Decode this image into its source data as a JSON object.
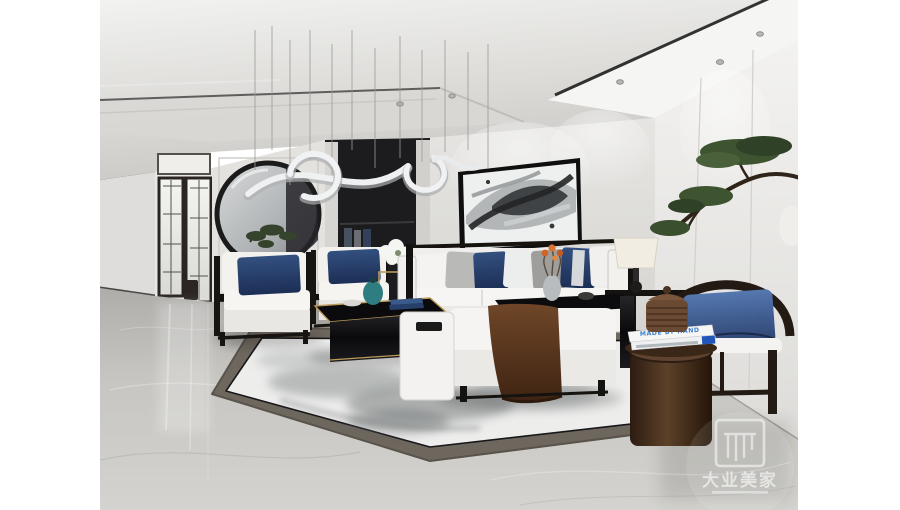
{
  "scene": {
    "type": "interior-rendering",
    "subject": "modern Chinese style living room with white sofa set, ink-wash rug and bonsai pine"
  },
  "watermark": {
    "logo_text": "大业美家"
  },
  "books": {
    "top_book_title": "MADE BY HAND"
  },
  "palette": {
    "page_background": "#ffffff",
    "wall_gray": "#e2e1de",
    "ceiling_light": "#efefed",
    "dark_niche": "#1c1b1d",
    "floor_marble": "#c2c1bd",
    "rug_field": "#ededec",
    "rug_border": "#6e675e",
    "accent_navy": "#2b3f66",
    "accent_steel_blue": "#44649c",
    "accent_teal": "#2e7d80",
    "throw_brown": "#5d3a24",
    "wood_dark": "#1d1813",
    "gold_trim": "#bd9a58",
    "bonsai_green": "#3e5330",
    "book_blue": "#2f6fc4"
  }
}
